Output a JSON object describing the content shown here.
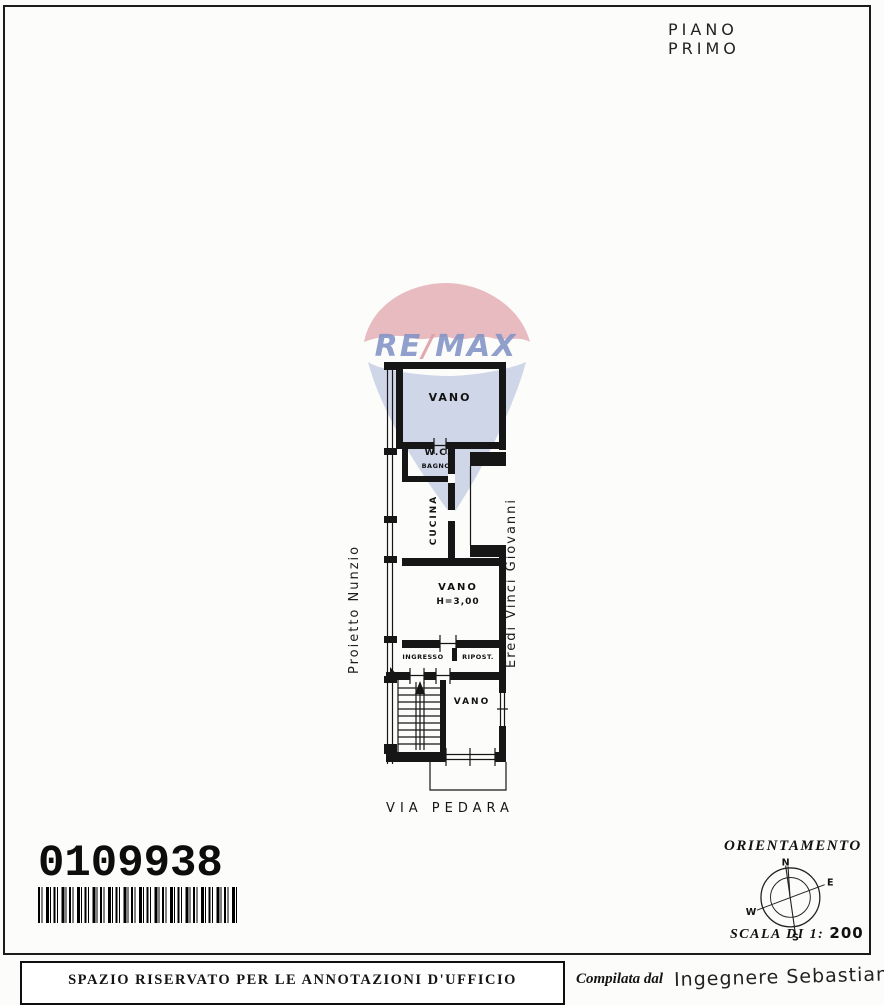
{
  "header": {
    "floor_label": "PIANO PRIMO"
  },
  "plan": {
    "street_label": "VIA PEDARA",
    "left_owner": "Proietto Nunzio",
    "right_owner": "Eredi Vinci Giovanni",
    "rooms": {
      "vano_top": "VANO",
      "wc": "W.C.",
      "bagno": "BAGNO",
      "cucina": "CUCINA",
      "vano_mid": "VANO",
      "vano_mid_height": "H=3,00",
      "ingresso": "INGRESSO",
      "ripostiglio": "RIPOST.",
      "vano_bottom": "VANO"
    }
  },
  "watermark": {
    "re": "RE",
    "slash": "/",
    "max": "MAX"
  },
  "barcode": {
    "number": "0109938"
  },
  "orientation": {
    "title": "ORIENTAMENTO",
    "north": "N",
    "east": "E",
    "south": "S",
    "west": "W",
    "scale_label": "SCALA DI 1:",
    "scale_value": "200"
  },
  "footer": {
    "office_note": "SPAZIO RISERVATO PER LE ANNOTAZIONI D'UFFICIO",
    "compiled_prefix": "Compilata dal",
    "compiled_name": "Ingegnere Sebastiano"
  },
  "colors": {
    "ink": "#1a1a1a",
    "remax_red": "#e2a6ae",
    "remax_blue": "#8595c6",
    "balloon_blue": "#c3cce2"
  }
}
